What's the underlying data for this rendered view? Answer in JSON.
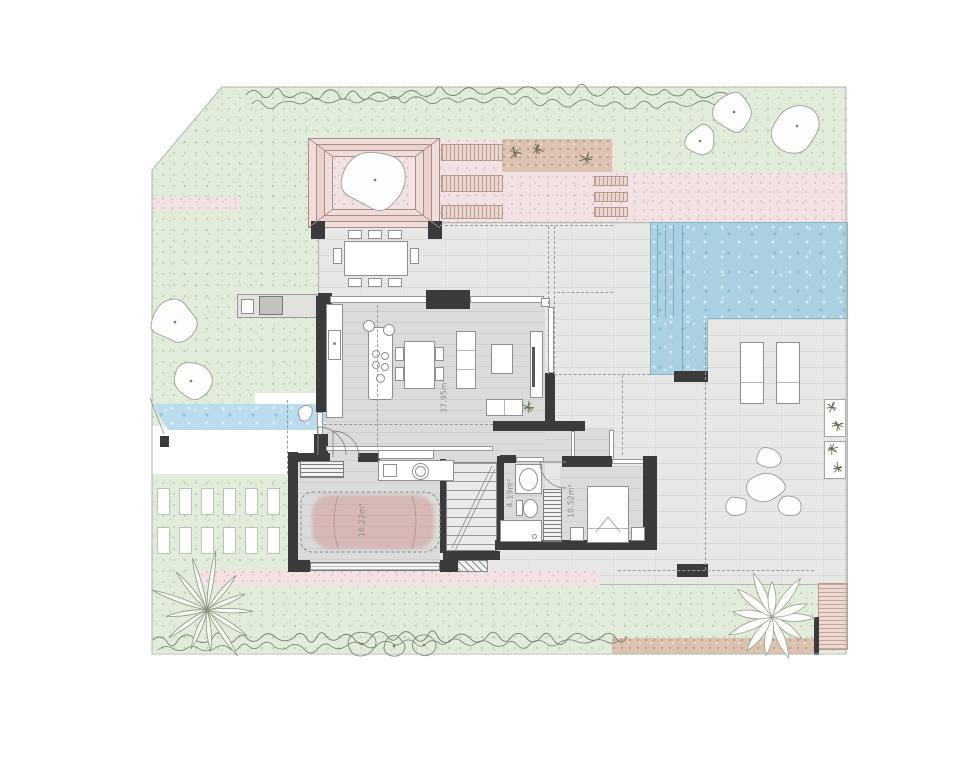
{
  "plan": {
    "rooms": [
      {
        "name": "living-dining-kitchen",
        "area_label": "37.95m²"
      },
      {
        "name": "garage",
        "area_label": "16.22m²"
      },
      {
        "name": "bathroom",
        "area_label": "4.19m²"
      },
      {
        "name": "bedroom",
        "area_label": "10.52m²"
      }
    ],
    "outdoor_features": [
      "lawn",
      "hedge",
      "trees",
      "pergola",
      "timber-bench-slats",
      "pink-gravel-path",
      "tan-gravel-bed",
      "stepping-stones",
      "outdoor-kitchen",
      "outdoor-dining-table",
      "swimming-pool",
      "sun-loungers",
      "planters",
      "rock-garden",
      "water-feature",
      "grass-driveway-pavers",
      "palm-tree",
      "shrub-circles",
      "agave-plant",
      "wood-deck"
    ],
    "colors": {
      "lawn": "#e1ecda",
      "pool_water": "#a9d1e2",
      "pink_gravel": "#f3e2e3",
      "tan_gravel": "#dcc3b1",
      "paving": "#e7e7e5",
      "interior_floor": "#dbdbd9",
      "wall": "#3b3b3b",
      "car_highlight": "#cd8282",
      "deck": "#ecd9d2"
    }
  }
}
